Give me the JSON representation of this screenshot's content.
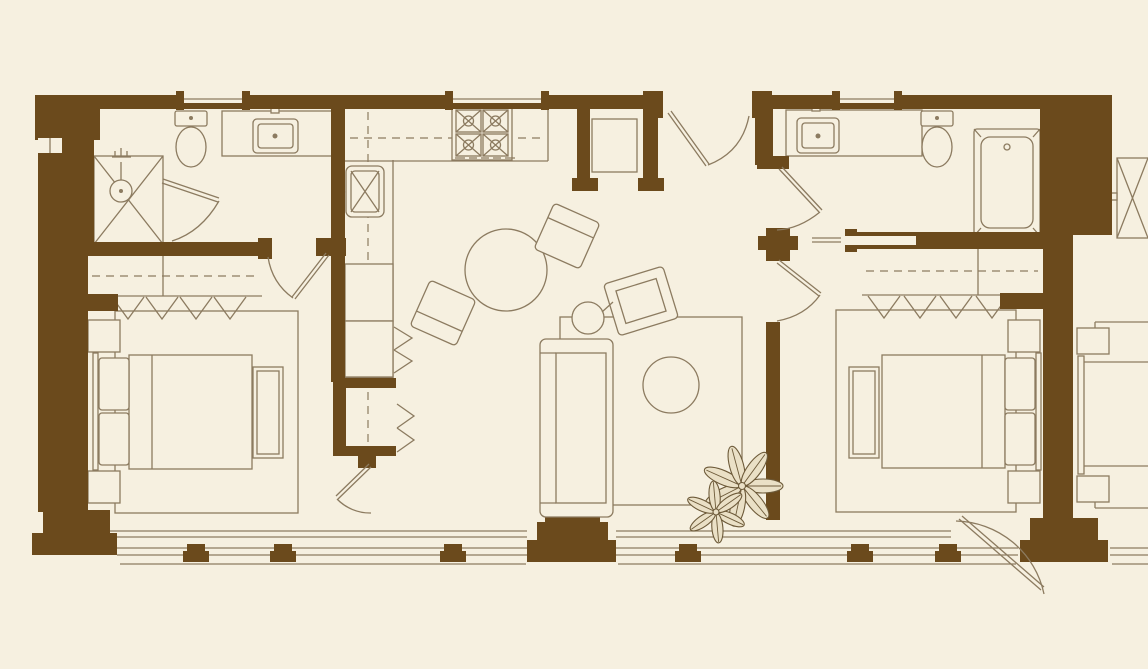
{
  "title": "two-bedroom-suite-floor-plan",
  "canvas": {
    "width": 1148,
    "height": 669
  },
  "colors": {
    "bg": "#F6F0E0",
    "wall": "#6B4A1C",
    "line": "#8C7B60",
    "fill": "#F6F0E0",
    "plant-line": "#6D5A39",
    "plant-fill": "#EAE0C6"
  },
  "plan": {
    "type": "floor-plan",
    "rooms": [
      "left-bathroom",
      "left-bedroom",
      "kitchen",
      "dining-area",
      "entry-foyer",
      "living-room",
      "right-bathroom",
      "right-bedroom",
      "balcony-terrace",
      "neighbor-unit-partial"
    ],
    "fixtures": [
      "shower-stall",
      "toilet",
      "vanity-sink",
      "kitchen-stove",
      "kitchen-sink",
      "refrigerator",
      "dining-table",
      "dining-chair",
      "entry-closet",
      "sofa",
      "coffee-table",
      "armchair",
      "floor-lamp",
      "bathtub",
      "closet-hangers",
      "bed",
      "pillows",
      "nightstand",
      "bench",
      "area-rug",
      "potted-plant",
      "balcony-column",
      "balcony-railing",
      "window",
      "door-swing",
      "pocket-door"
    ]
  }
}
